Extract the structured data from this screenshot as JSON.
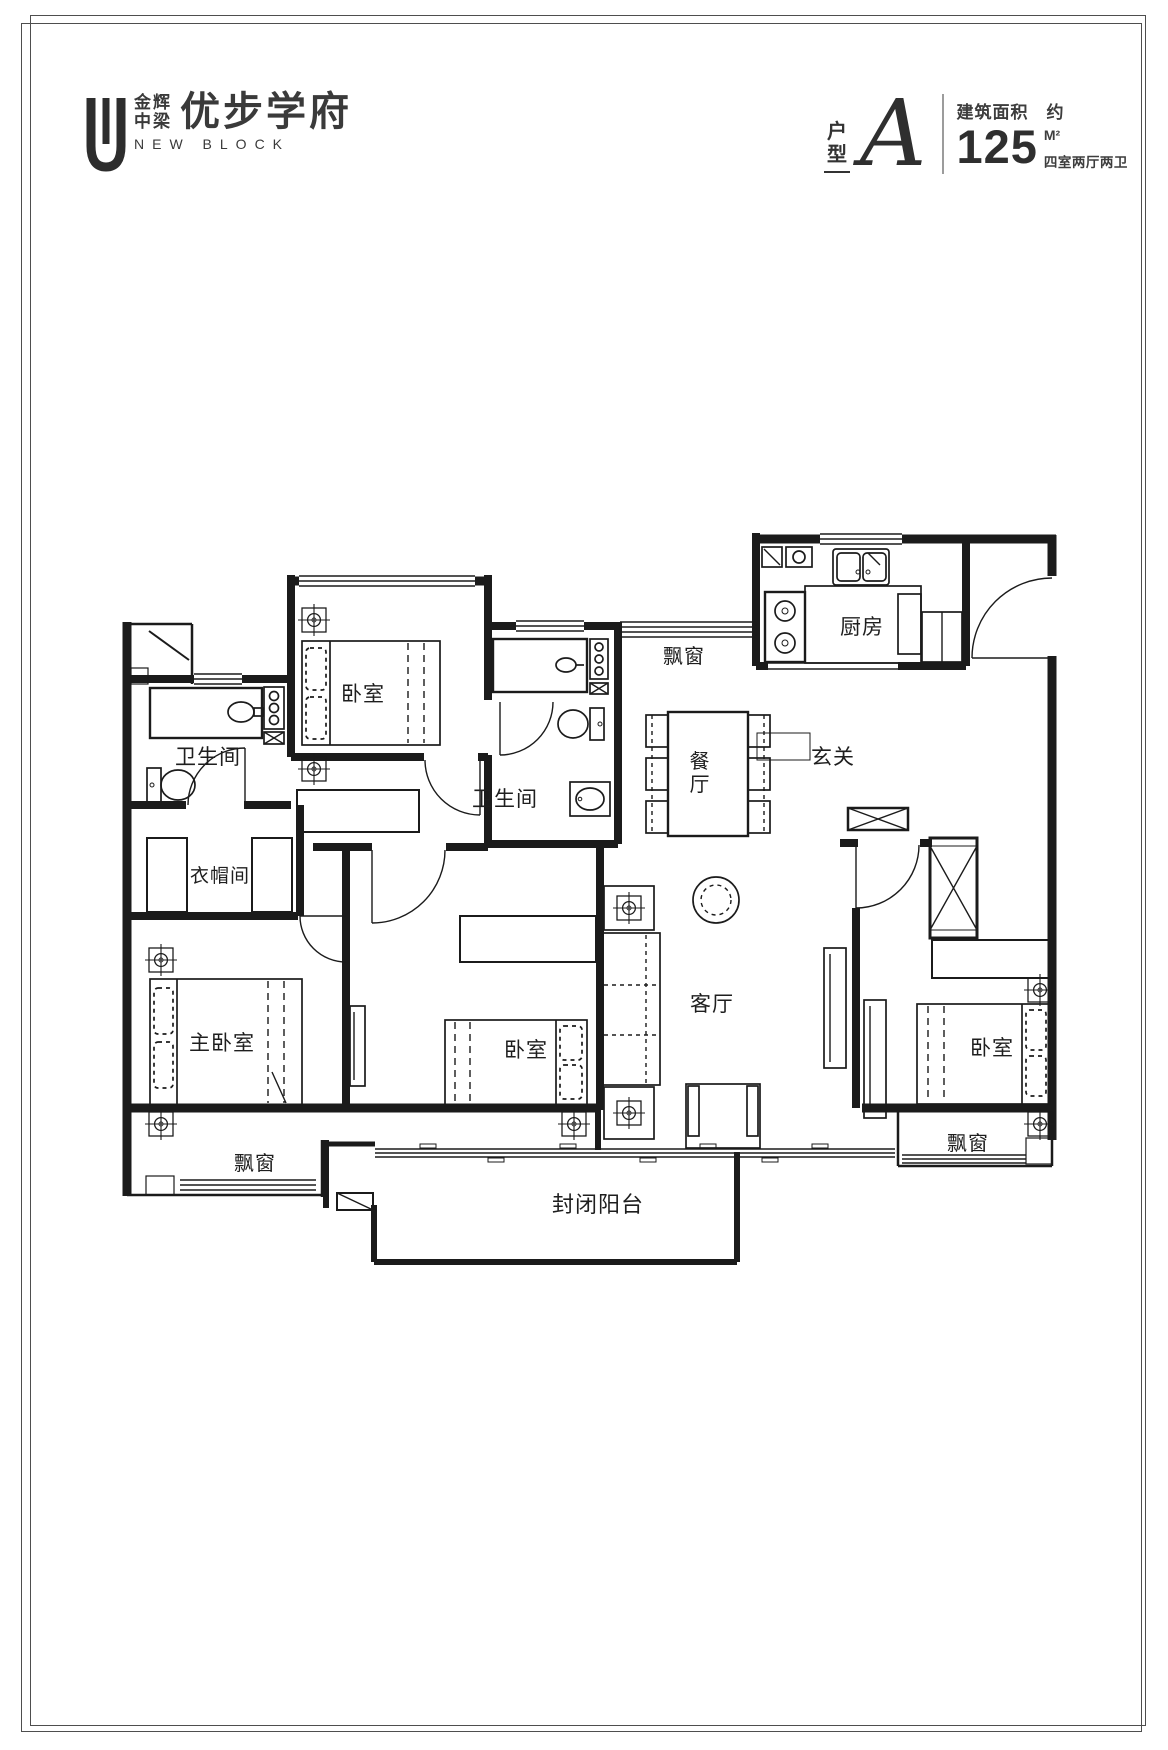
{
  "header": {
    "logo": {
      "brand_line1": "金辉",
      "brand_line2": "中梁",
      "name_cn": "优步学府",
      "name_en": "NEW BLOCK"
    },
    "unit": {
      "type_char1": "户",
      "type_char2": "型",
      "type_letter": "A",
      "area_title": "建筑面积",
      "area_approx": "约",
      "area_value": "125",
      "area_unit": "M²",
      "layout_text": "四室两厅两卫"
    }
  },
  "floorplan": {
    "rooms": [
      {
        "key": "bathroom-north",
        "label": "卫生间",
        "x": 208,
        "y": 764,
        "size": 21
      },
      {
        "key": "bedroom-north",
        "label": "卧室",
        "x": 363,
        "y": 701,
        "size": 21
      },
      {
        "key": "bathroom-middle",
        "label": "卫生间",
        "x": 505,
        "y": 806,
        "size": 21
      },
      {
        "key": "bay-window-top",
        "label": "飘窗",
        "x": 684,
        "y": 663,
        "size": 20
      },
      {
        "key": "kitchen",
        "label": "厨房",
        "x": 862,
        "y": 634,
        "size": 21
      },
      {
        "key": "foyer",
        "label": "玄关",
        "x": 833,
        "y": 764,
        "size": 21
      },
      {
        "key": "dining",
        "label": "餐厅",
        "x": 700,
        "y": 768,
        "size": 20,
        "vertical": true
      },
      {
        "key": "cloakroom",
        "label": "衣帽间",
        "x": 220,
        "y": 882,
        "size": 19
      },
      {
        "key": "master-bedroom",
        "label": "主卧室",
        "x": 222,
        "y": 1050,
        "size": 21
      },
      {
        "key": "bedroom-middle",
        "label": "卧室",
        "x": 526,
        "y": 1057,
        "size": 21
      },
      {
        "key": "living-room",
        "label": "客厅",
        "x": 712,
        "y": 1011,
        "size": 21
      },
      {
        "key": "bedroom-east",
        "label": "卧室",
        "x": 992,
        "y": 1055,
        "size": 21
      },
      {
        "key": "bay-window-sw",
        "label": "飘窗",
        "x": 255,
        "y": 1170,
        "size": 20
      },
      {
        "key": "bay-window-se",
        "label": "飘窗",
        "x": 968,
        "y": 1150,
        "size": 20
      },
      {
        "key": "balcony",
        "label": "封闭阳台",
        "x": 598,
        "y": 1212,
        "size": 22
      }
    ]
  }
}
